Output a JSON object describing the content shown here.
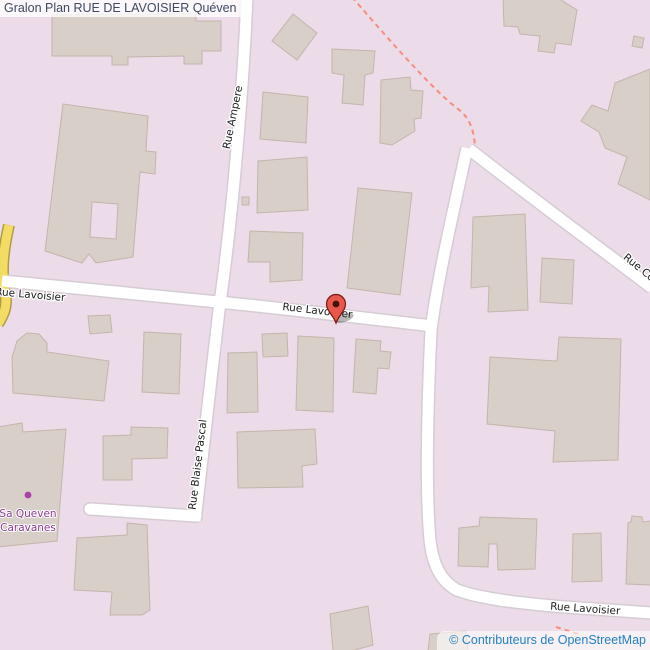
{
  "title": "Gralon Plan RUE DE LAVOISIER Quéven",
  "attribution": "© Contributeurs de OpenStreetMap",
  "streets": {
    "rue_ampere": "Rue Ampere",
    "rue_blaise_pascal": "Rue Blaise Pascal",
    "rue_lavoisier": "Rue Lavoisier",
    "rue_co_partial": "Rue Co"
  },
  "poi": {
    "line1": "Sa Queven",
    "line2": "Caravanes"
  },
  "marker": {
    "type": "location-pin",
    "street": "Rue Lavoisier"
  },
  "colors": {
    "background": "#ecdce9",
    "building_fill": "#d7cfc8",
    "building_outline": "#c3b5aa",
    "road_fill": "#ffffff",
    "road_casing": "#d6ccd3",
    "secondary_road_fill": "#f3dc66",
    "secondary_road_casing": "#b19b45",
    "path_dashed": "#f78d7d",
    "street_label": "#1a1a1a",
    "poi_label": "#8a3a8f",
    "poi_dot": "#ab3fab",
    "marker_fill": "#e8574c",
    "marker_outline": "#7e150d",
    "title_text": "#3d4a60",
    "attribution_text": "#2680c2"
  }
}
